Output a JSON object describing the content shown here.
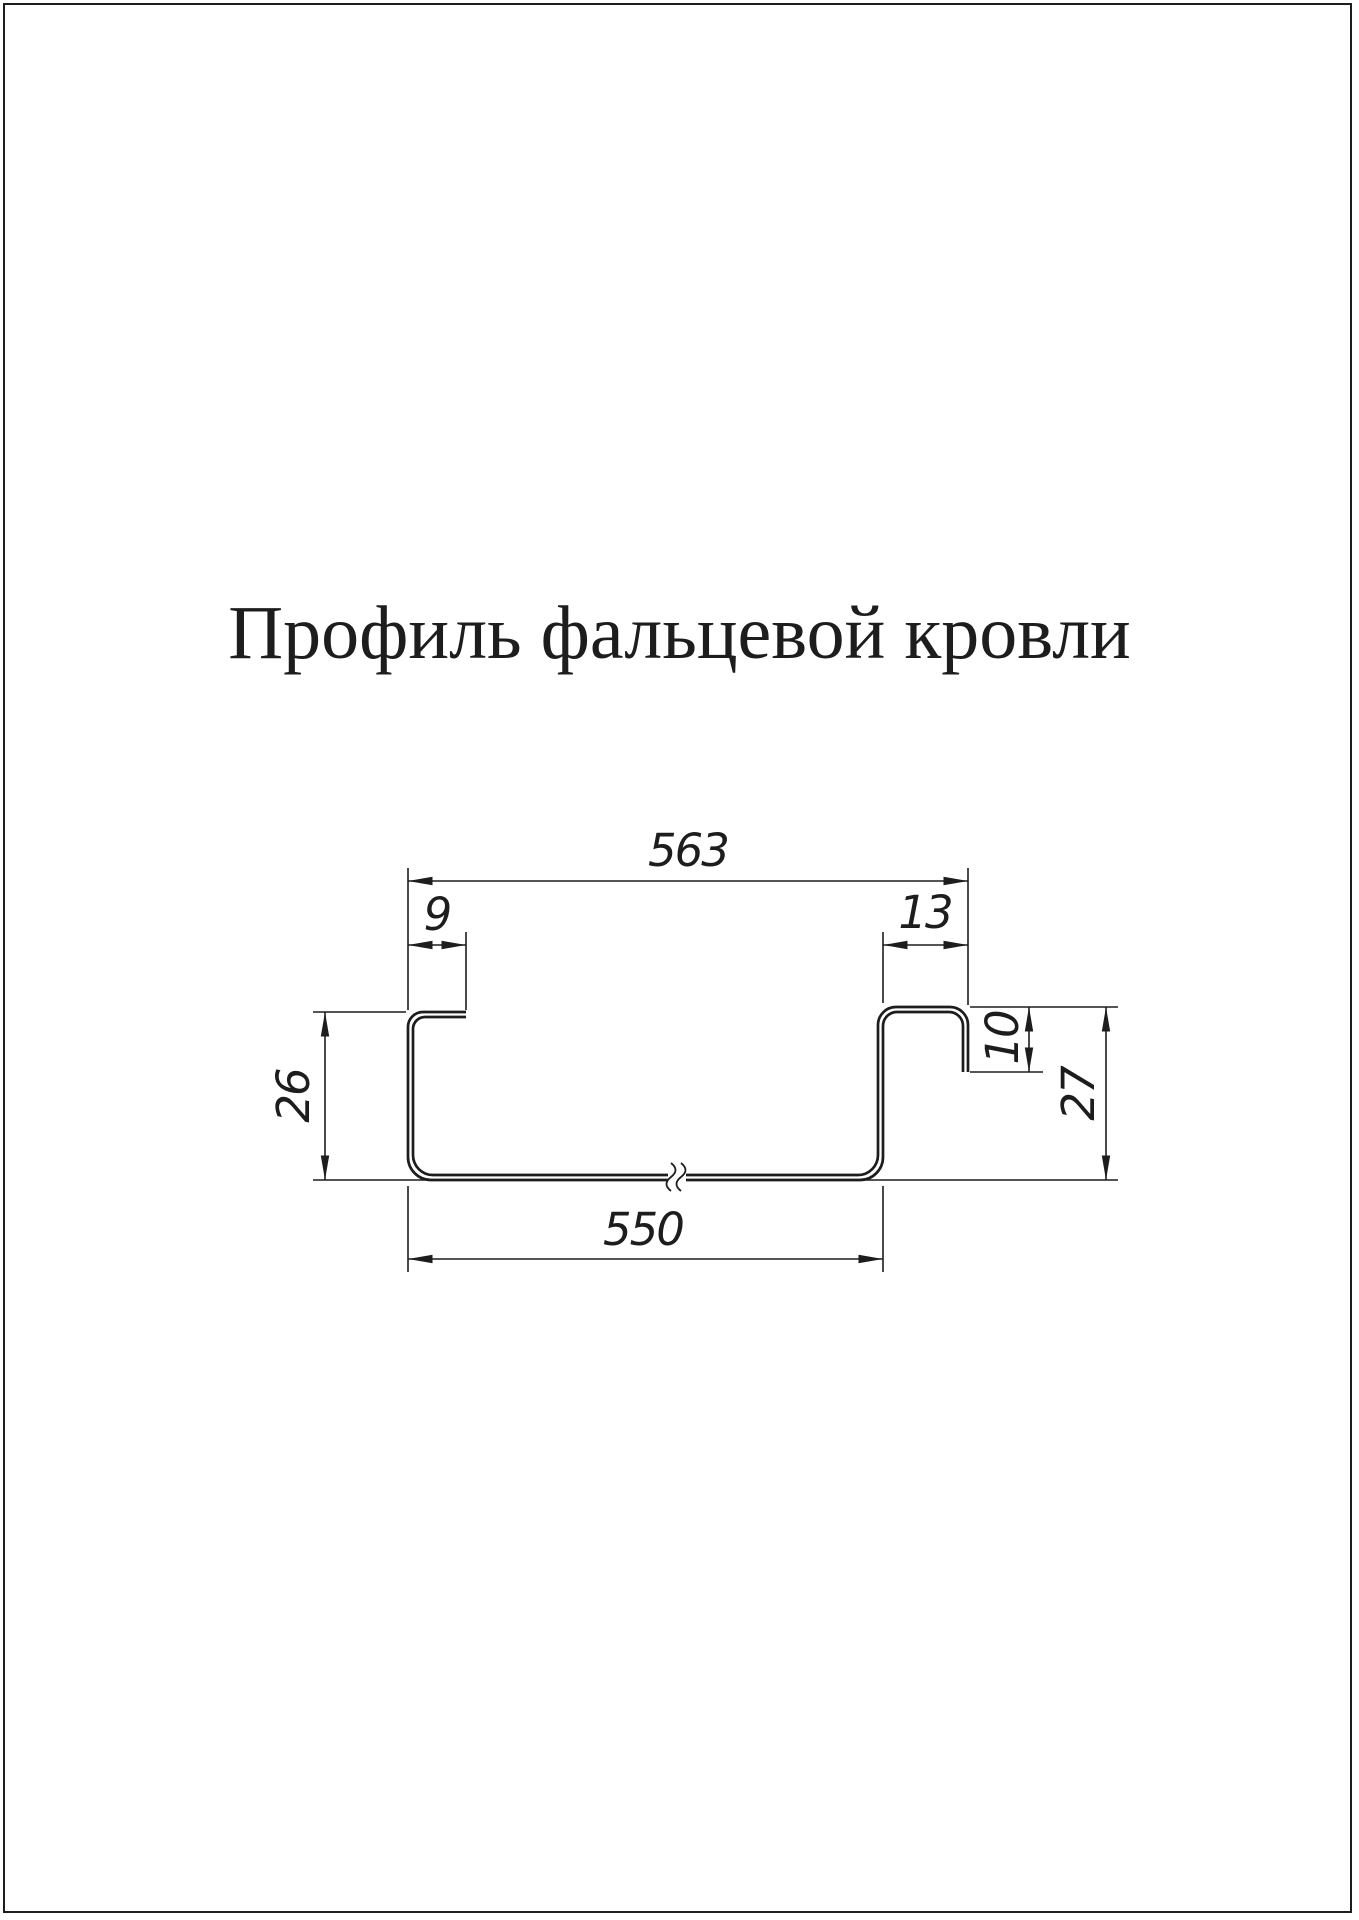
{
  "title": "Профиль фальцевой кровли",
  "drawing": {
    "dimensions": {
      "total_width": "563",
      "left_lip_width": "9",
      "right_hook_width": "13",
      "left_height": "26",
      "right_hook_drop": "10",
      "right_height": "27",
      "bottom_width": "550"
    },
    "colors": {
      "ink": "#1d1d1d",
      "background": "#ffffff"
    }
  }
}
